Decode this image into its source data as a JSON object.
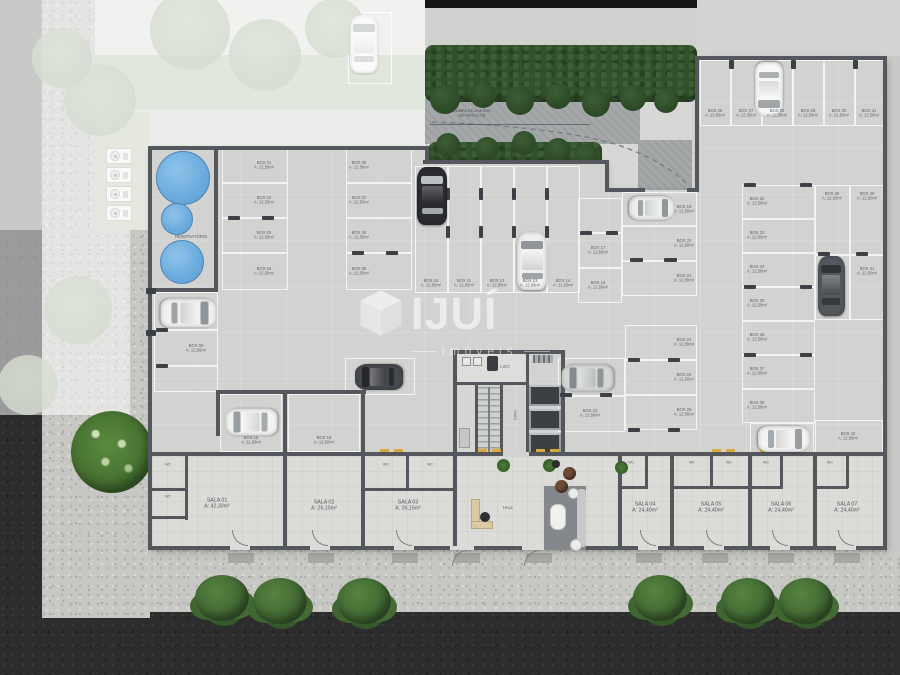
{
  "watermark": {
    "brand": "IJUÍ",
    "sub": "imóveis"
  },
  "notes": {
    "ramp": "RAMPA DE ACESSO\nDE VEÍCULOS",
    "reservoir": "RESERVATÓRIO",
    "hall": "HALL",
    "circ": "CIRC.",
    "trash": "LIXO"
  },
  "areas": {
    "box": "A: 12,50m²"
  },
  "colors": {
    "asphalt": "#2d2d2d",
    "gravel": "#c7c7c4",
    "garage_floor": "#d2d3d0",
    "room_floor": "#dbdcd8",
    "wall": "#54575b",
    "hedge": "#31502c",
    "grass": "#4f7a3b",
    "pool": "#63a4da",
    "marker_yellow": "#d9a93f",
    "label": "#5d636b",
    "watermark_white": "rgba(255,255,255,0.58)"
  },
  "parking": {
    "boxes": [
      [
        "BOX 01",
        222,
        148,
        66,
        35,
        264,
        166
      ],
      [
        "BOX 02",
        222,
        183,
        66,
        35,
        264,
        201
      ],
      [
        "BOX 03",
        222,
        218,
        66,
        35,
        264,
        236
      ],
      [
        "BOX 04",
        222,
        253,
        66,
        37,
        264,
        272
      ],
      [
        "BOX 05",
        154,
        330,
        64,
        36,
        196,
        349
      ],
      [
        "BOX 06",
        346,
        148,
        66,
        35,
        359,
        166
      ],
      [
        "BOX 07",
        346,
        183,
        66,
        35,
        359,
        201
      ],
      [
        "BOX 08",
        346,
        218,
        66,
        35,
        359,
        236
      ],
      [
        "BOX 09",
        346,
        253,
        66,
        37,
        359,
        272
      ],
      [
        "BOX 10",
        415,
        166,
        33,
        127,
        431,
        284
      ],
      [
        "BOX 11",
        448,
        166,
        33,
        127,
        464,
        284
      ],
      [
        "BOX 12",
        481,
        166,
        33,
        127,
        497,
        284
      ],
      [
        "BOX 13",
        514,
        166,
        33,
        127,
        530,
        284
      ],
      [
        "BOX 14",
        547,
        166,
        33,
        127,
        563,
        284
      ],
      [
        "BOX 15",
        220,
        394,
        62,
        58,
        251,
        441
      ],
      [
        "BOX 16",
        288,
        394,
        72,
        58,
        324,
        441
      ],
      [
        "BOX 17",
        578,
        233,
        44,
        35,
        598,
        251
      ],
      [
        "BOX 18",
        578,
        268,
        44,
        35,
        598,
        286
      ],
      [
        "BOX 19",
        622,
        192,
        75,
        34,
        684,
        210
      ],
      [
        "BOX 20",
        622,
        226,
        75,
        35,
        684,
        244
      ],
      [
        "BOX 21",
        622,
        261,
        75,
        35,
        684,
        279
      ],
      [
        "BOX 22",
        558,
        396,
        67,
        36,
        590,
        414
      ],
      [
        "BOX 23",
        625,
        325,
        72,
        35,
        684,
        343
      ],
      [
        "BOX 24",
        625,
        360,
        72,
        35,
        684,
        378
      ],
      [
        "BOX 25",
        625,
        395,
        72,
        35,
        684,
        413
      ],
      [
        "BOX 26",
        700,
        60,
        31,
        66,
        715,
        114
      ],
      [
        "BOX 27",
        731,
        60,
        31,
        66,
        746,
        114
      ],
      [
        "BOX 28",
        762,
        60,
        31,
        66,
        777,
        114
      ],
      [
        "BOX 29",
        793,
        60,
        31,
        66,
        808,
        114
      ],
      [
        "BOX 30",
        824,
        60,
        31,
        66,
        839,
        114
      ],
      [
        "BOX 31",
        855,
        60,
        29,
        66,
        869,
        114
      ],
      [
        "BOX 32",
        742,
        185,
        73,
        34,
        757,
        202
      ],
      [
        "BOX 33",
        742,
        219,
        73,
        34,
        757,
        236
      ],
      [
        "BOX 34",
        742,
        253,
        73,
        34,
        757,
        270
      ],
      [
        "BOX 35",
        742,
        287,
        73,
        34,
        757,
        304
      ],
      [
        "BOX 36",
        742,
        321,
        73,
        34,
        757,
        338
      ],
      [
        "BOX 37",
        742,
        355,
        73,
        34,
        757,
        372
      ],
      [
        "BOX 38",
        742,
        389,
        73,
        34,
        757,
        406
      ],
      [
        "BOX 39",
        815,
        185,
        35,
        70,
        832,
        197
      ],
      [
        "BOX 40",
        850,
        185,
        35,
        70,
        867,
        197
      ],
      [
        "BOX 41",
        850,
        255,
        35,
        65,
        867,
        272
      ],
      [
        "BOX 42",
        815,
        420,
        68,
        35,
        848,
        437
      ]
    ],
    "lines": [
      [
        578,
        198,
        44,
        35
      ],
      [
        154,
        292,
        64,
        38
      ],
      [
        154,
        366,
        64,
        26
      ],
      [
        345,
        358,
        70,
        37
      ],
      [
        558,
        358,
        67,
        38
      ],
      [
        815,
        255,
        35,
        65
      ],
      [
        750,
        423,
        64,
        33
      ]
    ],
    "stops": [
      [
        446,
        188,
        4,
        12
      ],
      [
        479,
        188,
        4,
        12
      ],
      [
        512,
        188,
        4,
        12
      ],
      [
        545,
        188,
        4,
        12
      ],
      [
        446,
        226,
        4,
        12
      ],
      [
        479,
        226,
        4,
        12
      ],
      [
        512,
        226,
        4,
        12
      ],
      [
        545,
        226,
        4,
        12
      ],
      [
        580,
        231,
        12,
        4
      ],
      [
        606,
        231,
        12,
        4
      ],
      [
        630,
        258,
        13,
        4
      ],
      [
        664,
        258,
        13,
        4
      ],
      [
        744,
        183,
        12,
        4
      ],
      [
        800,
        183,
        12,
        4
      ],
      [
        744,
        285,
        12,
        4
      ],
      [
        800,
        285,
        12,
        4
      ],
      [
        744,
        353,
        12,
        4
      ],
      [
        800,
        353,
        12,
        4
      ],
      [
        818,
        252,
        12,
        4
      ],
      [
        856,
        252,
        12,
        4
      ],
      [
        156,
        328,
        12,
        4
      ],
      [
        156,
        364,
        12,
        4
      ],
      [
        560,
        393,
        12,
        4
      ],
      [
        600,
        393,
        12,
        4
      ],
      [
        628,
        358,
        12,
        4
      ],
      [
        668,
        358,
        12,
        4
      ],
      [
        628,
        428,
        12,
        4
      ],
      [
        668,
        428,
        12,
        4
      ],
      [
        228,
        216,
        12,
        4
      ],
      [
        262,
        216,
        12,
        4
      ],
      [
        352,
        251,
        12,
        4
      ],
      [
        386,
        251,
        12,
        4
      ],
      [
        729,
        60,
        5,
        9
      ],
      [
        791,
        60,
        5,
        9
      ],
      [
        853,
        60,
        5,
        9
      ],
      [
        146,
        288,
        10,
        6
      ],
      [
        146,
        330,
        10,
        6
      ]
    ]
  },
  "rooms": {
    "wc_label": "WC",
    "wcs": [
      [
        168,
        470
      ],
      [
        168,
        502
      ],
      [
        386,
        470
      ],
      [
        430,
        470
      ],
      [
        631,
        468
      ],
      [
        692,
        468
      ],
      [
        729,
        468
      ],
      [
        766,
        468
      ],
      [
        830,
        468
      ]
    ],
    "salas": [
      [
        "SALA 01",
        "A: 42,30m²",
        217,
        504
      ],
      [
        "SALA 02",
        "A: 26,15m²",
        324,
        506
      ],
      [
        "SALA 03",
        "A: 26,15m²",
        408,
        506
      ],
      [
        "SALA 04",
        "A: 24,40m²",
        645,
        508
      ],
      [
        "SALA 05",
        "A: 24,40m²",
        711,
        508
      ],
      [
        "SALA 06",
        "A: 24,40m²",
        781,
        508
      ],
      [
        "SALA 07",
        "A: 24,40m²",
        847,
        508
      ]
    ]
  },
  "cars": [
    [
      364,
      44,
      28,
      58,
      0,
      "#f4f5f4",
      "#a7adb0",
      "n"
    ],
    [
      769,
      89,
      28,
      54,
      180,
      "#f7f8f7",
      "#9fa5a8",
      ""
    ],
    [
      432,
      196,
      30,
      58,
      0,
      "#2a2c30",
      "#b9bfc3",
      ""
    ],
    [
      532,
      261,
      30,
      58,
      0,
      "#eff0ef",
      "#8f9598",
      ""
    ],
    [
      652,
      208,
      24,
      46,
      90,
      "#eceeed",
      "#90969a",
      ""
    ],
    [
      831,
      286,
      27,
      60,
      0,
      "#53585c",
      "#303438",
      ""
    ],
    [
      784,
      439,
      26,
      52,
      90,
      "#f2f3f2",
      "#989ea2",
      ""
    ],
    [
      587,
      378,
      27,
      52,
      270,
      "#d6d8d8",
      "#84898d",
      ""
    ],
    [
      379,
      377,
      26,
      48,
      270,
      "#46494e",
      "#25272b",
      ""
    ],
    [
      188,
      313,
      29,
      56,
      90,
      "#eff0ef",
      "#8f9598",
      ""
    ],
    [
      251,
      422,
      27,
      52,
      270,
      "#f2f3f2",
      "#989ea2",
      ""
    ]
  ],
  "pools": [
    [
      183,
      178,
      27
    ],
    [
      177,
      219,
      16
    ],
    [
      182,
      262,
      22
    ]
  ],
  "acs": [
    [
      106,
      148
    ],
    [
      106,
      167
    ],
    [
      106,
      186
    ],
    [
      106,
      205
    ]
  ],
  "landscape": {
    "bushes": [
      [
        222,
        597
      ],
      [
        280,
        600
      ],
      [
        364,
        600
      ],
      [
        660,
        597
      ],
      [
        748,
        600
      ],
      [
        806,
        600
      ]
    ],
    "big_tree": [
      112,
      452
    ],
    "ftrees": [
      [
        100,
        100,
        36
      ],
      [
        190,
        30,
        40
      ],
      [
        265,
        55,
        36
      ],
      [
        335,
        28,
        30
      ],
      [
        62,
        58,
        30
      ],
      [
        78,
        310,
        34
      ],
      [
        28,
        385,
        30
      ]
    ],
    "hedge_top": [
      425,
      45,
      272,
      57
    ],
    "hedge_bottom": [
      428,
      142,
      174,
      52
    ],
    "hedge_lumps": [
      [
        445,
        99,
        15
      ],
      [
        483,
        95,
        13
      ],
      [
        520,
        101,
        14
      ],
      [
        558,
        96,
        13
      ],
      [
        596,
        103,
        14
      ],
      [
        633,
        98,
        13
      ],
      [
        666,
        101,
        12
      ],
      [
        448,
        145,
        12
      ],
      [
        487,
        149,
        12
      ],
      [
        524,
        143,
        12
      ],
      [
        558,
        150,
        12
      ],
      [
        586,
        156,
        12
      ]
    ]
  },
  "structure": {
    "walls": [
      [
        148,
        146,
        281,
        4
      ],
      [
        425,
        146,
        4,
        16
      ],
      [
        423,
        160,
        186,
        4
      ],
      [
        605,
        160,
        4,
        31
      ],
      [
        605,
        188,
        40,
        4
      ],
      [
        687,
        188,
        12,
        4
      ],
      [
        695,
        58,
        4,
        133
      ],
      [
        695,
        56,
        192,
        4
      ],
      [
        883,
        56,
        4,
        494
      ],
      [
        148,
        546,
        739,
        4
      ],
      [
        148,
        146,
        4,
        404
      ],
      [
        148,
        452,
        739,
        4
      ],
      [
        216,
        390,
        150,
        4
      ],
      [
        216,
        390,
        4,
        46
      ],
      [
        283,
        392,
        4,
        158
      ],
      [
        361,
        392,
        4,
        158
      ],
      [
        453,
        452,
        4,
        98
      ],
      [
        618,
        452,
        4,
        98
      ],
      [
        670,
        452,
        4,
        98
      ],
      [
        748,
        452,
        4,
        98
      ],
      [
        813,
        452,
        4,
        98
      ],
      [
        214,
        146,
        4,
        146
      ],
      [
        152,
        288,
        64,
        4
      ],
      [
        453,
        350,
        112,
        4
      ],
      [
        453,
        350,
        4,
        106
      ],
      [
        561,
        350,
        4,
        106
      ],
      [
        475,
        384,
        3,
        70
      ],
      [
        500,
        384,
        3,
        70
      ],
      [
        526,
        352,
        3,
        102
      ],
      [
        456,
        382,
        72,
        3
      ],
      [
        150,
        488,
        38,
        3
      ],
      [
        185,
        452,
        3,
        68
      ],
      [
        150,
        516,
        38,
        3
      ],
      [
        363,
        488,
        92,
        3
      ],
      [
        406,
        452,
        3,
        38
      ],
      [
        618,
        486,
        30,
        3
      ],
      [
        645,
        452,
        3,
        36
      ],
      [
        672,
        486,
        78,
        3
      ],
      [
        710,
        452,
        3,
        36
      ],
      [
        750,
        486,
        33,
        3
      ],
      [
        780,
        452,
        3,
        36
      ],
      [
        813,
        486,
        35,
        3
      ],
      [
        846,
        452,
        3,
        36
      ]
    ],
    "gaps": [
      [
        503,
        452,
        26,
        4,
        "#d2d3d0"
      ],
      [
        230,
        546,
        20,
        4,
        "#dbdcd8"
      ],
      [
        310,
        546,
        20,
        4,
        "#dbdcd8"
      ],
      [
        394,
        546,
        20,
        4,
        "#dbdcd8"
      ],
      [
        450,
        546,
        24,
        4,
        "#dbdcd8"
      ],
      [
        522,
        546,
        24,
        4,
        "#dbdcd8"
      ],
      [
        638,
        546,
        20,
        4,
        "#dbdcd8"
      ],
      [
        704,
        546,
        20,
        4,
        "#dbdcd8"
      ],
      [
        770,
        546,
        20,
        4,
        "#dbdcd8"
      ],
      [
        836,
        546,
        20,
        4,
        "#dbdcd8"
      ]
    ],
    "arcs": [
      [
        232,
        530,
        "in"
      ],
      [
        312,
        530,
        "in"
      ],
      [
        396,
        530,
        "in"
      ],
      [
        640,
        530,
        "in"
      ],
      [
        706,
        530,
        "in"
      ],
      [
        772,
        530,
        "in"
      ],
      [
        838,
        530,
        "in"
      ],
      [
        452,
        550,
        "out"
      ],
      [
        524,
        550,
        "out"
      ]
    ],
    "pads": [
      [
        228,
        553
      ],
      [
        308,
        553
      ],
      [
        392,
        553
      ],
      [
        454,
        553
      ],
      [
        526,
        553
      ],
      [
        636,
        553
      ],
      [
        702,
        553
      ],
      [
        768,
        553
      ],
      [
        834,
        553
      ]
    ],
    "ydash": [
      [
        380,
        449
      ],
      [
        394,
        449
      ],
      [
        478,
        449
      ],
      [
        492,
        449
      ],
      [
        536,
        449
      ],
      [
        550,
        449
      ],
      [
        712,
        449
      ],
      [
        726,
        449
      ],
      [
        760,
        449
      ],
      [
        774,
        449
      ]
    ]
  }
}
